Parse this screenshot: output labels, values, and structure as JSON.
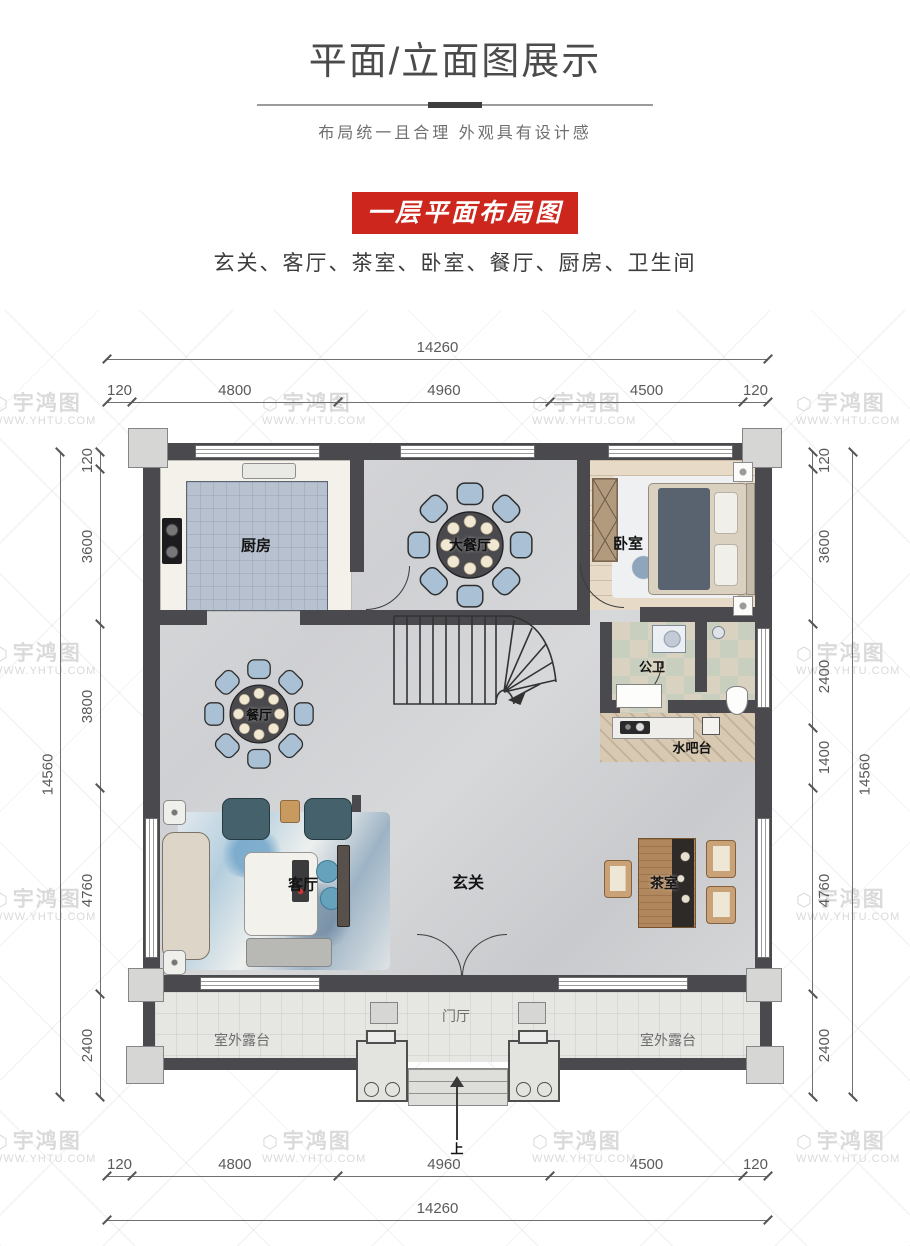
{
  "header": {
    "title": "平面/立面图展示",
    "subtitle": "布局统一且合理 外观具有设计感"
  },
  "banner": {
    "label": "一层平面布局图"
  },
  "rooms_line": "玄关、客厅、茶室、卧室、餐厅、厨房、卫生间",
  "watermark": {
    "logo": "⬡",
    "brand": "宇鸿图",
    "url": "WWW.YHTU.COM"
  },
  "plan": {
    "labels": {
      "kitchen": "厨房",
      "big_dining": "大餐厅",
      "bedroom": "卧室",
      "bath": "公卫",
      "water_bar": "水吧台",
      "dining": "餐厅",
      "living": "客厅",
      "foyer": "玄关",
      "tea_room": "茶室",
      "entry_hall": "门厅",
      "terrace_left": "室外露台",
      "terrace_right": "室外露台",
      "up": "上"
    },
    "dims": {
      "top_total": "14260",
      "top_segments": [
        "120",
        "4800",
        "4960",
        "4500",
        "120"
      ],
      "bottom_segments": [
        "120",
        "4800",
        "4960",
        "4500",
        "120"
      ],
      "bottom_total": "14260",
      "left_total": "14560",
      "left_segments": [
        "120",
        "3600",
        "3800",
        "4760",
        "2400"
      ],
      "right_total": "14560",
      "right_segments": [
        "120",
        "3600",
        "2400",
        "1400",
        "4760",
        "2400"
      ]
    },
    "colors": {
      "banner_red": "#cd271d",
      "wall": "#4a4a4e",
      "kitchen_tile": "#b7c1d0",
      "chair_blue": "#a9c0d5",
      "wood_floor": "#e7dac6"
    }
  }
}
